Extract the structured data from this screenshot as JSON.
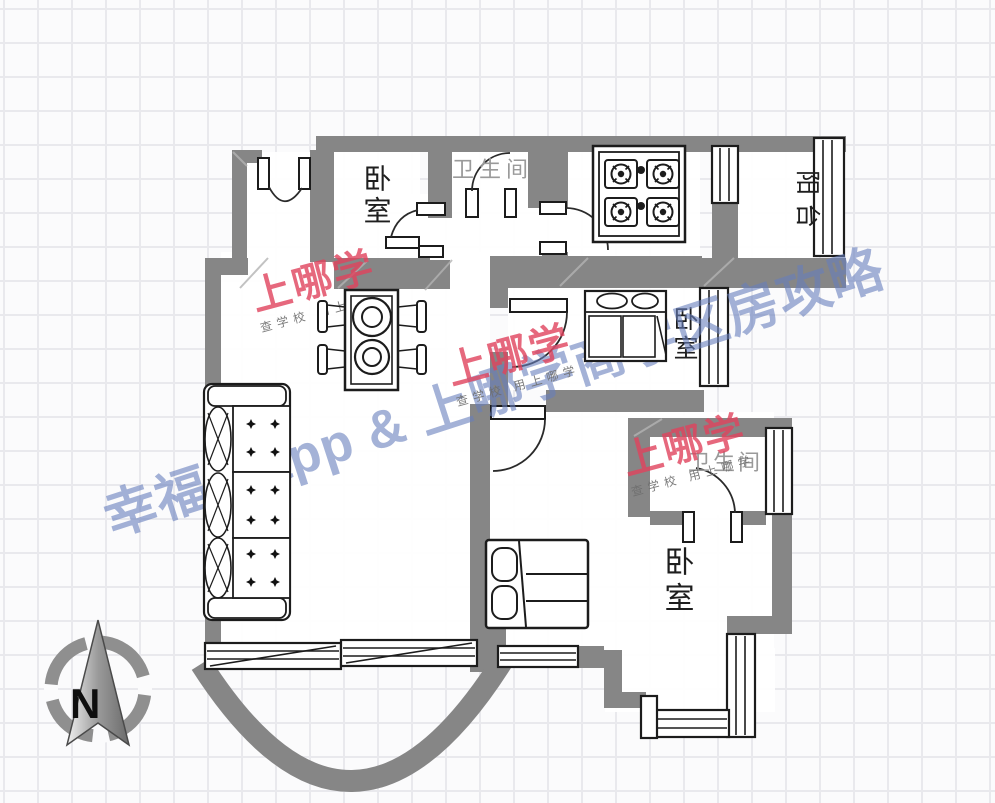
{
  "plan": {
    "rooms": {
      "bedroom_top_left": {
        "label": "卧室"
      },
      "bathroom_top": {
        "label": "卫生间"
      },
      "balcony": {
        "label": "阳台"
      },
      "bedroom_middle": {
        "label": "卧室"
      },
      "bathroom_bottom": {
        "label": "卫生间"
      },
      "bedroom_bottom": {
        "label": "卧室"
      }
    },
    "furniture_icons": [
      "sofa",
      "dining-table",
      "gas-stove",
      "wardrobe",
      "double-bed"
    ]
  },
  "watermarks": {
    "brand_line": "幸福里app & 上哪学商学区房攻略",
    "stamp_main": "上哪学",
    "stamp_sub": "查学校 用上哪学"
  },
  "compass": {
    "north_label": "N"
  },
  "colors": {
    "wall_gray": "#868686",
    "line_black": "#1c1c1c",
    "label_gray": "#9a9a9a",
    "watermark_red": "rgba(224,66,92,0.8)",
    "watermark_blue": "rgba(104,126,188,0.6)"
  }
}
